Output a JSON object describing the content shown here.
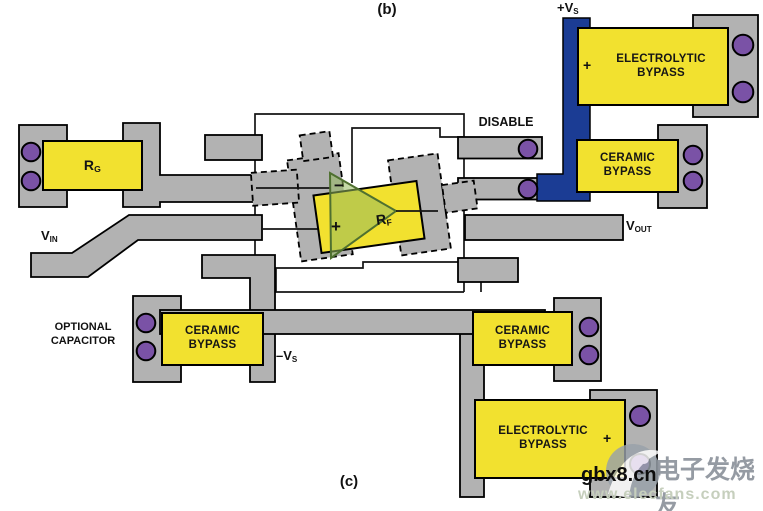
{
  "figure": {
    "panel_b": "(b)",
    "panel_c": "(c)"
  },
  "nets": {
    "vs_pos": {
      "base": "+V",
      "sub": "S"
    },
    "vs_neg": {
      "base": "–V",
      "sub": "S"
    },
    "vin": {
      "base": "V",
      "sub": "IN"
    },
    "vout": {
      "base": "V",
      "sub": "OUT"
    },
    "disable": "DISABLE"
  },
  "annotations": {
    "optional_capacitor": {
      "line1": "OPTIONAL",
      "line2": "CAPACITOR"
    }
  },
  "components": {
    "rg": {
      "base": "R",
      "sub": "G"
    },
    "rf": {
      "base": "R",
      "sub": "F"
    },
    "electrolytic_top": {
      "line1": "ELECTROLYTIC",
      "line2": "BYPASS",
      "polarity": "+"
    },
    "ceramic_top": {
      "line1": "CERAMIC",
      "line2": "BYPASS"
    },
    "ceramic_left": {
      "line1": "CERAMIC",
      "line2": "BYPASS"
    },
    "ceramic_right": {
      "line1": "CERAMIC",
      "line2": "BYPASS"
    },
    "electrolytic_bottom": {
      "line1": "ELECTROLYTIC",
      "line2": "BYPASS",
      "polarity": "+"
    }
  },
  "opamp": {
    "inverting": "−",
    "noninverting": "+"
  },
  "watermark": {
    "site": "gbx8.cn",
    "brand": "电子发烧友",
    "url": "www.elecfans.com"
  },
  "colors": {
    "copper": "#b2b2b2",
    "component": "#f2e12f",
    "supply_trace": "#1b3c94",
    "via": "#7a52a6",
    "opamp_fill": "#96b95f"
  }
}
